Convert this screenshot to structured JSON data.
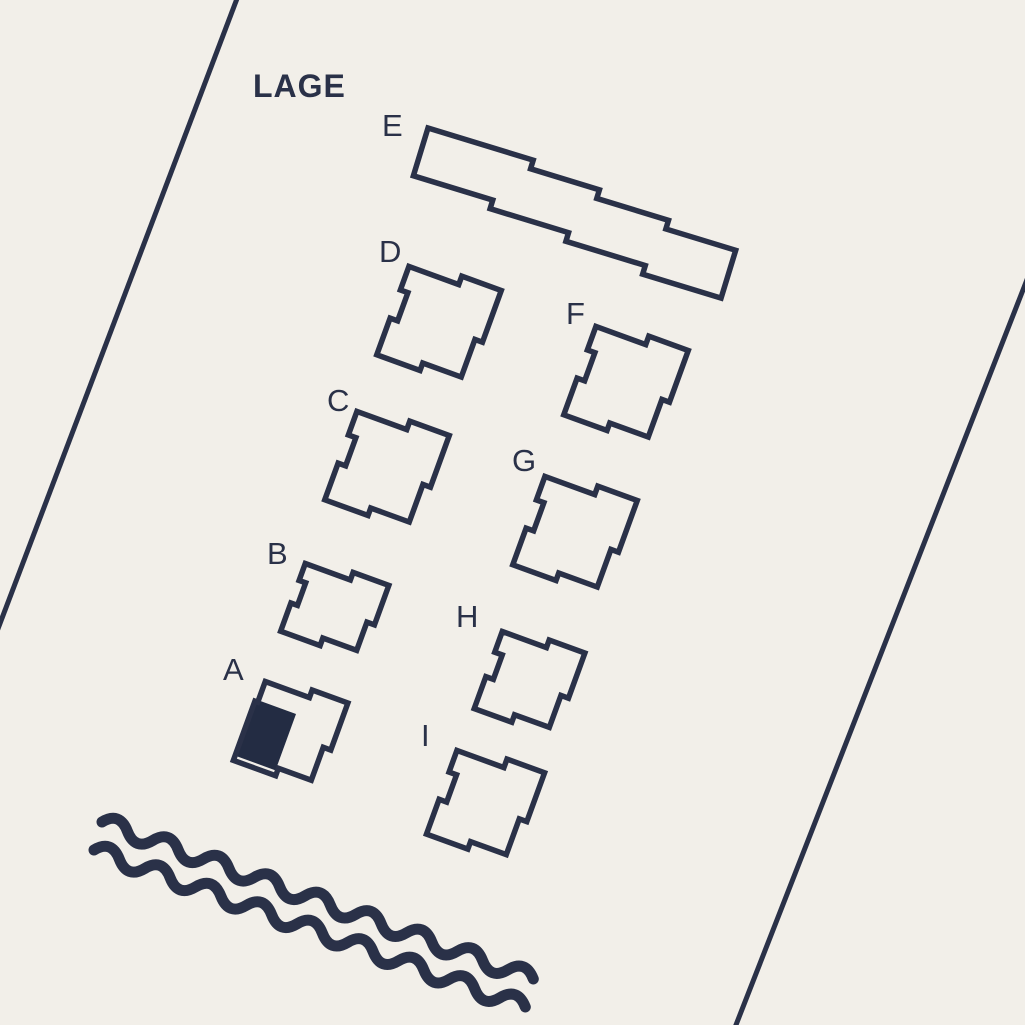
{
  "title": "LAGE",
  "colors": {
    "background": "#f2efe9",
    "ink": "#2a3148",
    "highlight_fill": "#232c43"
  },
  "buildings": [
    {
      "id": "E",
      "label": "E",
      "highlighted": false
    },
    {
      "id": "D",
      "label": "D",
      "highlighted": false
    },
    {
      "id": "F",
      "label": "F",
      "highlighted": false
    },
    {
      "id": "C",
      "label": "C",
      "highlighted": false
    },
    {
      "id": "G",
      "label": "G",
      "highlighted": false
    },
    {
      "id": "B",
      "label": "B",
      "highlighted": false
    },
    {
      "id": "H",
      "label": "H",
      "highlighted": false
    },
    {
      "id": "A",
      "label": "A",
      "highlighted": true
    },
    {
      "id": "I",
      "label": "I",
      "highlighted": false
    }
  ],
  "highlighted_building": "A",
  "features": {
    "water_icon": "wavy-lines",
    "boundary_lines": 2
  }
}
